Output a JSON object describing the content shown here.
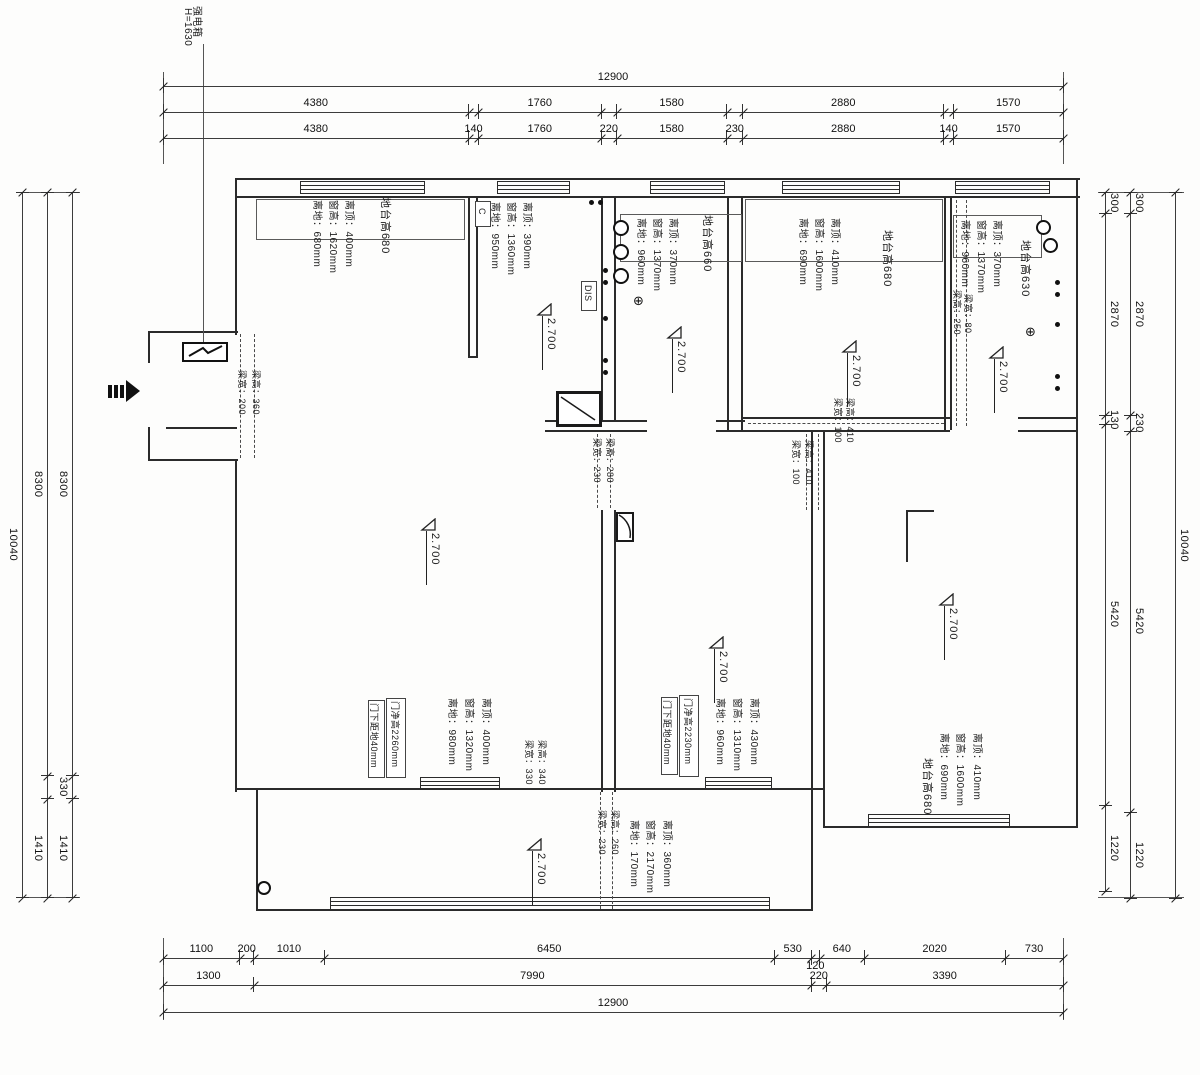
{
  "meta": {
    "panel_label": "强电箱",
    "panel_height": "H=1630",
    "dis_label": "DIS",
    "fixture_c": "C",
    "power_symbol": "⊕"
  },
  "ceiling_height": "2.700",
  "dimensions": {
    "top": {
      "total": "12900",
      "row_mid": [
        "4380",
        "1760",
        "1580",
        "2880",
        "1570"
      ],
      "row_inner": [
        "4380",
        "140",
        "1760",
        "220",
        "1580",
        "230",
        "2880",
        "140",
        "1570"
      ]
    },
    "bottom": {
      "row_inner": [
        "1100",
        "200",
        "1010",
        "6450",
        "530",
        "120",
        "640",
        "2020",
        "730"
      ],
      "row_mid": [
        "1300",
        "7990",
        "220",
        "3390"
      ],
      "total": "12900"
    },
    "left": {
      "inner": [
        "8300",
        "330",
        "1410"
      ],
      "mid": [
        "8300",
        "1410"
      ],
      "total": "10040"
    },
    "right": {
      "inner": [
        "300",
        "2870",
        "130",
        "5420",
        "1220"
      ],
      "mid": [
        "300",
        "2870",
        "230",
        "5420",
        "1220"
      ],
      "total": "10040"
    }
  },
  "rooms": {
    "r1": {
      "platform": "地台高680",
      "top": "离顶：400mm",
      "height": "窗高：1620mm",
      "bottom": "离地：680mm"
    },
    "r1b": {
      "top": "离顶：390mm",
      "height": "窗高：1360mm",
      "bottom": "离地：950mm"
    },
    "r2": {
      "platform": "地台高660",
      "top": "离顶：370mm",
      "height": "窗高：1370mm",
      "bottom": "离地：960mm"
    },
    "r3": {
      "platform": "地台高680",
      "top": "离顶：410mm",
      "height": "窗高：1600mm",
      "bottom": "离地：690mm"
    },
    "r4": {
      "platform": "地台高630",
      "top": "离顶：370mm",
      "height": "窗高：1370mm",
      "bottom": "离地：960mm"
    },
    "master": {
      "door_height": "门净高2260mm",
      "door_gap": "门下距地40mm",
      "top": "离顶：400mm",
      "height": "窗高：1320mm",
      "bottom": "离地：980mm"
    },
    "mid": {
      "door_height": "门净高2230mm",
      "door_gap": "门下距地40mm",
      "top": "离顶：430mm",
      "height": "窗高：1310mm",
      "bottom": "离地：960mm"
    },
    "right": {
      "platform": "地台高680",
      "top": "离顶：410mm",
      "height": "窗高：1600mm",
      "bottom": "离地：690mm"
    },
    "balcony": {
      "top": "离顶：360mm",
      "height": "窗高：2170mm",
      "bottom": "离地：170mm"
    }
  },
  "beams": {
    "entry": {
      "w": "梁宽：200",
      "h": "梁高：360"
    },
    "center": {
      "w": "梁宽：230",
      "h": "梁高：280"
    },
    "r34": {
      "h": "梁高：250",
      "w": "梁宽：80"
    },
    "right_wall": {
      "w": "梁宽：100",
      "h": "梁高：410"
    },
    "right_v": {
      "w": "梁宽：100",
      "h": "梁高：410"
    },
    "balcony": {
      "w": "梁宽：230",
      "h": "梁高：260"
    },
    "master": {
      "w": "梁宽：330",
      "h": "梁高：340"
    }
  }
}
